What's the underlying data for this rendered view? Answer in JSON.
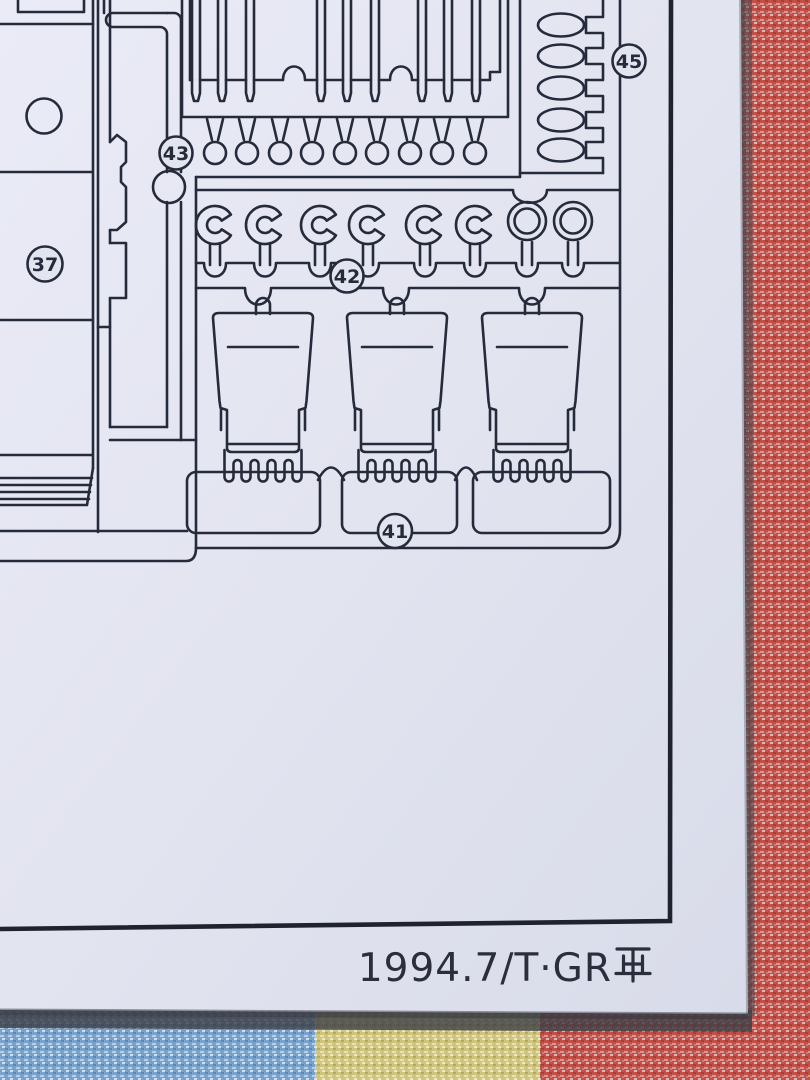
{
  "scene": {
    "description_labels": {
      "panel": "37",
      "seat_runner": "41",
      "c_hooks": "42",
      "small_rings": "43",
      "oval_links": "45"
    }
  },
  "sprue": {
    "labels": {
      "panel": "37",
      "seat_runner": "41",
      "c_hooks": "42",
      "small_rings": "43",
      "oval_links": "45"
    },
    "counts": {
      "top_bars": 9,
      "small_ring_row_circles": 9,
      "c_hooks": 6,
      "large_rings": 2,
      "oval_links": 5,
      "seats": 3,
      "teeth_per_seat": 5
    }
  },
  "footer": {
    "date_code": "1994.7/T・GR再",
    "date_code_latin": "1994.7/T·GR",
    "kanji_suffix": "再"
  },
  "colors": {
    "paper": "#e2e4f0",
    "ink": "#262b3c",
    "fabric_red": "#c15148",
    "fabric_blue": "#78a2cc",
    "fabric_yellow": "#d0c57e",
    "shadow": "#3c3e46"
  }
}
